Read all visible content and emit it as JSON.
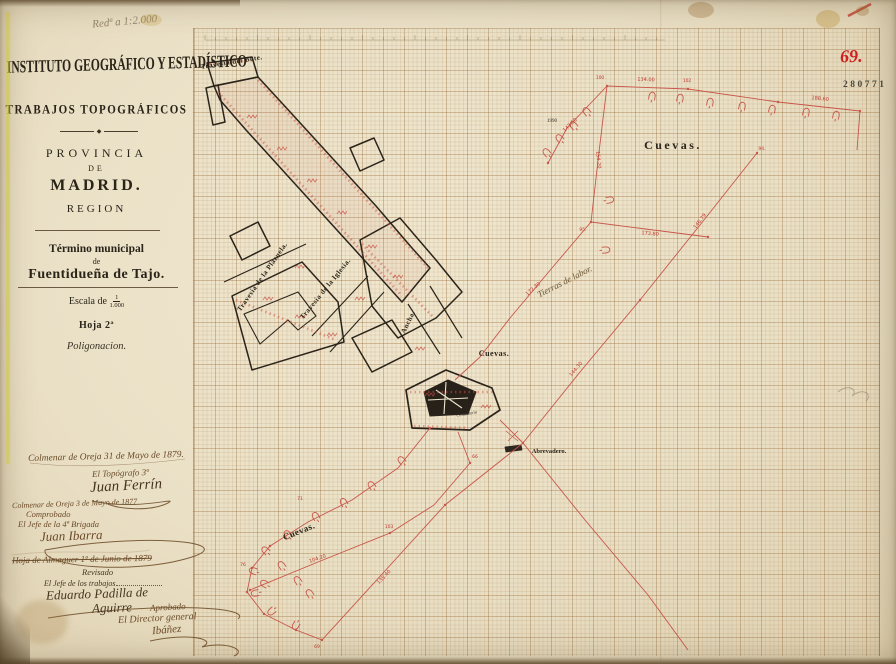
{
  "annotations": {
    "pencil_note": "Redª a 1:2.000",
    "sheet_number": "69.",
    "stamp_number": "280771"
  },
  "title_block": {
    "institution": "INSTITUTO GEOGRÁFICO Y ESTADÍSTICO",
    "works": "TRABAJOS TOPOGRÁFICOS",
    "ornament": "◆",
    "province_label": "PROVINCIA",
    "de1": "DE",
    "province": "MADRID.",
    "region": "REGION",
    "municipal_label": "Término municipal",
    "de2": "de",
    "municipality": "Fuentidueña de Tajo.",
    "scale_label": "Escala de",
    "scale_numerator": "1",
    "scale_denominator": "1.000",
    "sheet": "Hoja 2ª",
    "type": "Poligonacion."
  },
  "signatures": {
    "line1": "Colmenar de Oreja 31 de Mayo de 1879.",
    "role1": "El Topógrafo 3º",
    "sig1": "Juan Ferrín",
    "line2": "Colmenar de Oreja 3 de Mayo de 1877",
    "checked": "Comprobado",
    "role2": "El Jefe de la 4ª Brigada",
    "sig2": "Juan Ibarra",
    "struck_line": "Hoja de Almaguer 1º de Junio de 1879",
    "revised": "Revisado",
    "role3": "El Jefe de los trabajos",
    "sig3a": "Eduardo Padilla de",
    "sig3b": "Aguirre",
    "approved": "Aprobado",
    "role4": "El Director general",
    "sig4": "Ibáñez"
  },
  "map": {
    "labels": [
      {
        "text": "Travesía del Bote.",
        "x": 232,
        "y": 64,
        "angle": -9,
        "cls": "serif",
        "size": 7
      },
      {
        "text": "Travesía de la Plazuela.",
        "x": 264,
        "y": 278,
        "angle": -55,
        "cls": "serif",
        "size": 7
      },
      {
        "text": "Travesía de la Iglesia.",
        "x": 327,
        "y": 290,
        "angle": -51,
        "cls": "serif",
        "size": 7
      },
      {
        "text": "Ancha.",
        "x": 410,
        "y": 323,
        "angle": -64,
        "cls": "serif",
        "size": 7
      },
      {
        "text": "Cuevas.",
        "x": 494,
        "y": 356,
        "angle": 0,
        "cls": "serif",
        "size": 8
      },
      {
        "text": "Cuevas.",
        "x": 673,
        "y": 149,
        "angle": 0,
        "cls": "serifbig",
        "size": 12
      },
      {
        "text": "Cuevas.",
        "x": 300,
        "y": 534,
        "angle": -22,
        "cls": "serif",
        "size": 9
      },
      {
        "text": "Tierras de labor.",
        "x": 566,
        "y": 284,
        "angle": -27,
        "cls": "hand",
        "size": 9
      },
      {
        "text": "Cementerio",
        "x": 467,
        "y": 415,
        "angle": -10,
        "cls": "tiny",
        "size": 4.5
      },
      {
        "text": "Abrevadero.",
        "x": 549,
        "y": 453,
        "angle": 0,
        "cls": "tiny2",
        "size": 6.5
      },
      {
        "text": "1990",
        "x": 552,
        "y": 122,
        "angle": 0,
        "cls": "tiny",
        "size": 5
      }
    ],
    "stations": [
      {
        "text": "100",
        "x": 600,
        "y": 79
      },
      {
        "text": "102",
        "x": 687,
        "y": 82
      },
      {
        "text": "94.",
        "x": 762,
        "y": 150
      },
      {
        "text": "95.",
        "x": 583,
        "y": 231
      },
      {
        "text": "71",
        "x": 300,
        "y": 500
      },
      {
        "text": "76",
        "x": 243,
        "y": 566
      },
      {
        "text": "69",
        "x": 317,
        "y": 648
      },
      {
        "text": "103",
        "x": 389,
        "y": 528
      },
      {
        "text": "66",
        "x": 475,
        "y": 458
      }
    ],
    "measurements": [
      {
        "text": "134.00",
        "x": 646,
        "y": 81,
        "angle": 2
      },
      {
        "text": "188.60",
        "x": 820,
        "y": 100,
        "angle": 6
      },
      {
        "text": "143.50",
        "x": 571,
        "y": 126,
        "angle": -44
      },
      {
        "text": "154.20",
        "x": 597,
        "y": 160,
        "angle": 85
      },
      {
        "text": "173.80",
        "x": 650,
        "y": 235,
        "angle": 5
      },
      {
        "text": "172.30",
        "x": 534,
        "y": 290,
        "angle": -41
      },
      {
        "text": "146.79",
        "x": 701,
        "y": 222,
        "angle": -52
      },
      {
        "text": "144.30",
        "x": 577,
        "y": 370,
        "angle": -50
      },
      {
        "text": "135.40",
        "x": 385,
        "y": 578,
        "angle": -46
      },
      {
        "text": "104.20",
        "x": 318,
        "y": 560,
        "angle": -19
      }
    ]
  }
}
